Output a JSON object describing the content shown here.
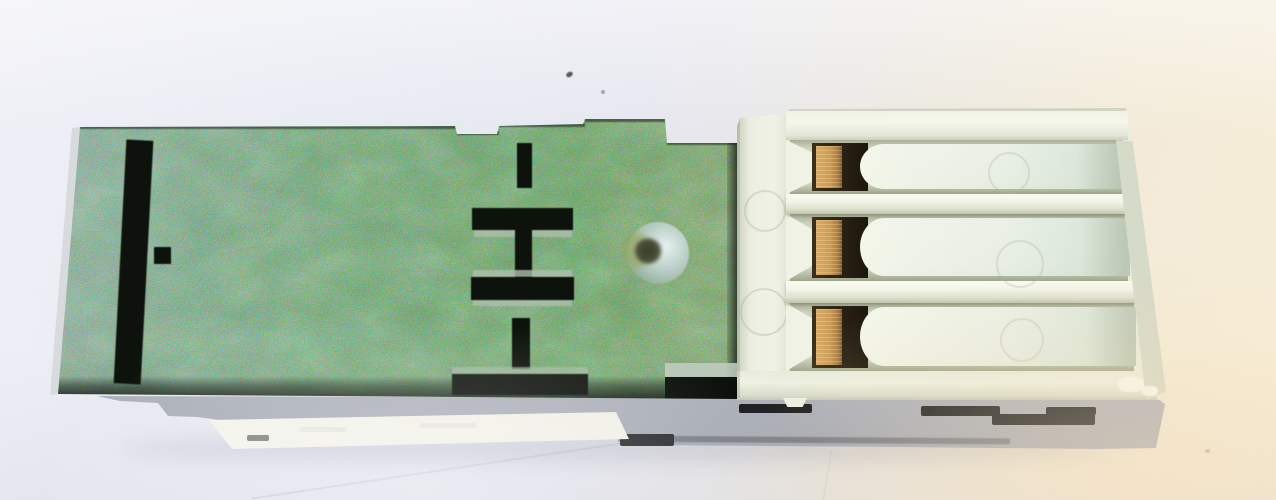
{
  "image": {
    "type": "photograph",
    "subject": "Industrial relay / terminal-block module photographed from directly above on an off-white paper background",
    "orientation": "module lying horizontally; mottled green board face on the left, cream plastic terminal block on the right, grey side wall with a blank sticker along the bottom"
  },
  "palette": {
    "background_left": "#e9ebf4",
    "background_right": "#f8efda",
    "pcb_green": "#6f9e73",
    "pcb_slot_black": "#0e120c",
    "plastic_cream": "#e9ecdd",
    "contact_brass": "#c69a58",
    "recess_brown": "#241d10",
    "side_grey": "#b7bac1",
    "sticker_white": "#f0efe8",
    "disc_translucent": "#d9e4ee"
  },
  "parts": {
    "pcb_top": {
      "label": "green board top with punched black slots",
      "visible_slots": 8,
      "has_round_translucent_window": true
    },
    "terminal_block": {
      "label": "cream plastic terminal block",
      "channel_count": 3,
      "contacts_per_channel": 1,
      "contact_material": "brass"
    },
    "module_side": {
      "label": "grey module side wall",
      "has_blank_sticker": true,
      "side_slot_count": 5
    },
    "background": {
      "label": "off-white paper backdrop",
      "speck_count": 3
    }
  },
  "aria": {
    "stage": "Photo of an electronic relay module on a light paper background",
    "pcb": "Mottled green circuit-board top with punched slots",
    "disc": "Round translucent window on the green board",
    "connector": "Cream three-channel terminal connector with brass contacts",
    "side": "Grey module side wall with blank sticker label",
    "sticker": "Blank white sticker on module side"
  }
}
